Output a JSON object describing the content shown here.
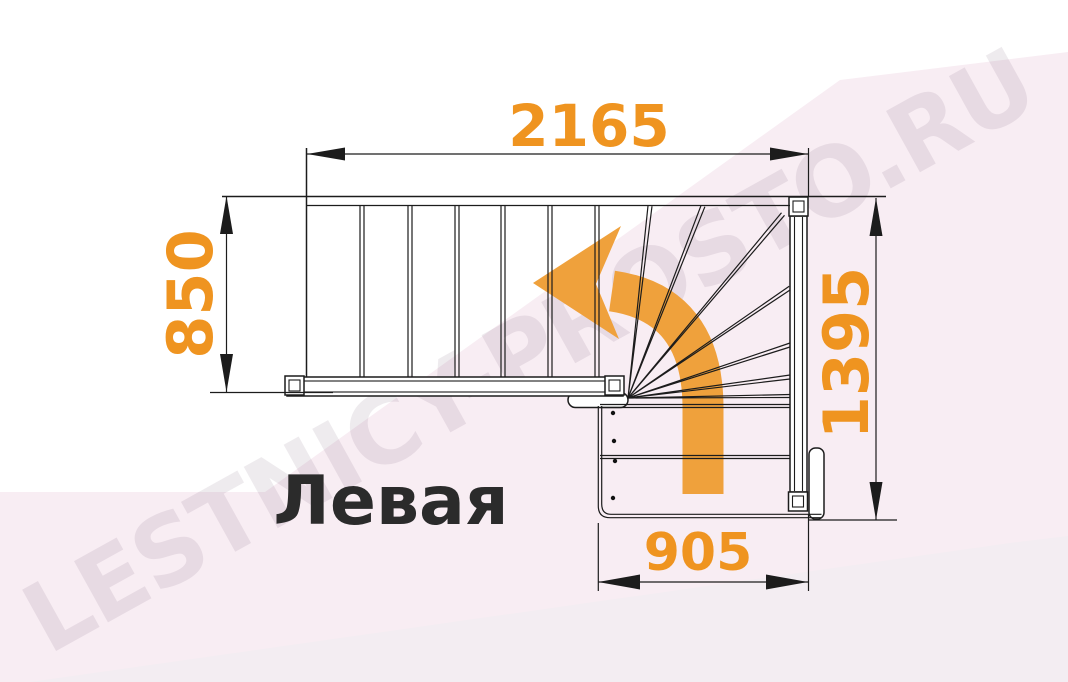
{
  "drawing": {
    "title_label": "Левая",
    "type_note": "L-shaped staircase plan view with winder turn",
    "turn_direction": "left"
  },
  "watermark": {
    "text": "LESTNICY-PROSTO.RU"
  },
  "dimensions": {
    "top_width_mm": "2165",
    "left_depth_mm": "850",
    "right_height_mm": "1395",
    "bottom_width_mm": "905"
  },
  "stair": {
    "upper_flight_straight_steps": 7,
    "winder_steps": 7,
    "lower_flight_steps": 3,
    "marker_dots": 4
  },
  "colors": {
    "dimension_text": "#EF9420",
    "turn_arrow": "#EFA13C",
    "linework": "#1c1c1c",
    "label_text": "#2b2b2b",
    "background_pink": "#f8edf3",
    "background_band": "#f3edf2",
    "watermark_gray": "rgba(90,60,85,0.10)"
  }
}
